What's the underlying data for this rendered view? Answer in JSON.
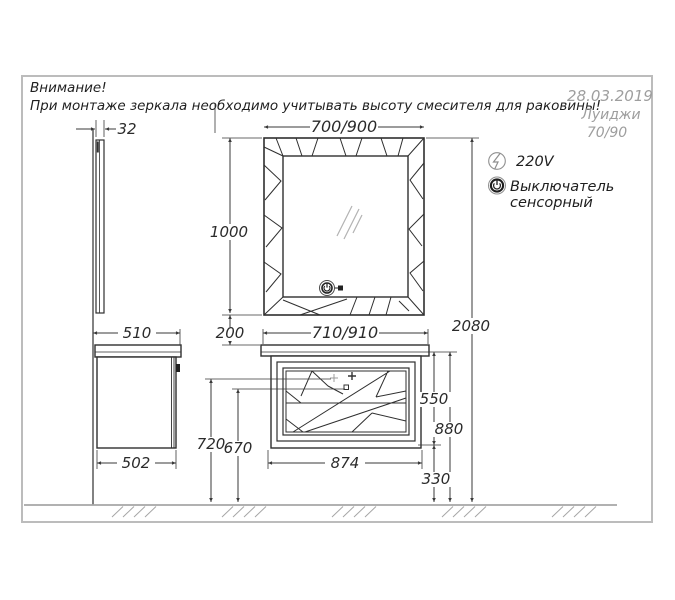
{
  "warning": {
    "line1": "Внимание!",
    "line2": "При монтаже зеркала необходимо учитывать высоту смесителя для раковины!"
  },
  "stamp": {
    "date": "28.03.2019",
    "model": "Луиджи",
    "size": "70/90"
  },
  "legend": {
    "power_label": "220V",
    "power_icon": "lightning-in-circle",
    "switch_label_line1": "Выключатель",
    "switch_label_line2": "сенсорный",
    "switch_icon": "touch-power-button"
  },
  "dimensions": {
    "mirror_depth": "32",
    "mirror_width": "700/900",
    "mirror_height": "1000",
    "overall_height": "2080",
    "countertop_depth": "510",
    "cabinet_depth": "502",
    "mirror_to_counter_gap": "200",
    "countertop_width": "710/910",
    "cabinet_body_width": "874",
    "front_panel_height": "550",
    "cabinet_height": "880",
    "floor_clearance": "330",
    "handle_height_left": "720",
    "handle_height_right": "670"
  },
  "colors": {
    "ink": "#2f2f2f",
    "dimension": "#3a3a3a",
    "muted": "#9e9e9e",
    "border": "#bcbcbc",
    "floor": "#a6a6a6",
    "background": "#ffffff"
  }
}
